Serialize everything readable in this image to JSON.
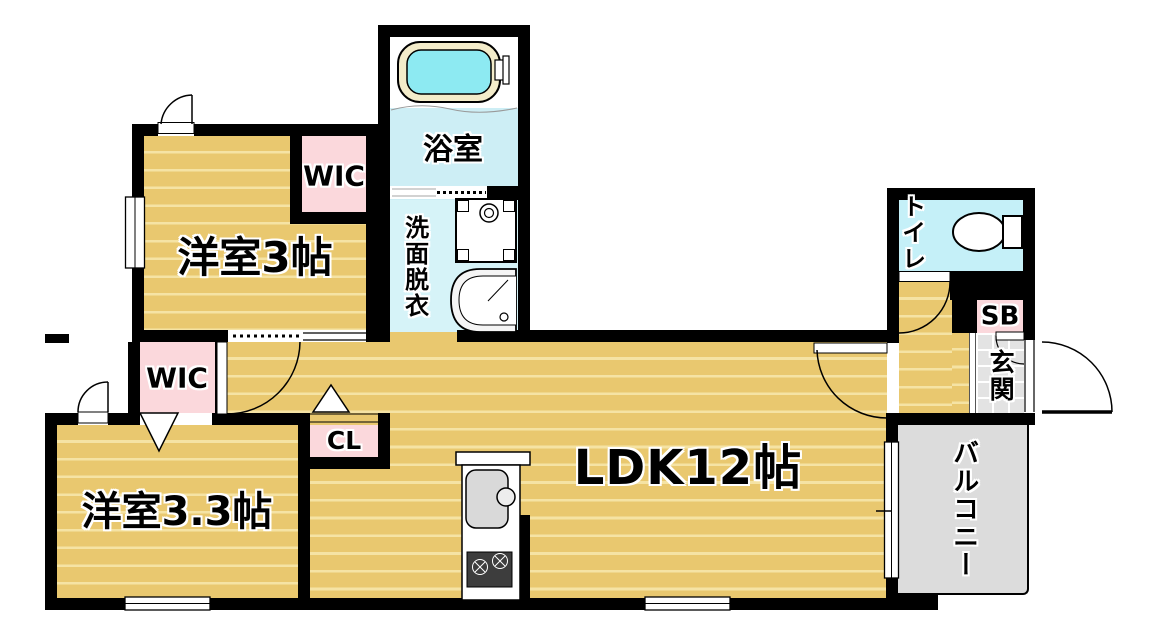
{
  "title": "apartment floor plan",
  "rooms": {
    "bedroom3": {
      "label": "洋室3帖"
    },
    "bedroom33": {
      "label": "洋室3.3帖"
    },
    "ldk": {
      "label": "LDK12帖"
    },
    "bath": {
      "label": "浴室"
    },
    "washroom": {
      "label": "洗面脱衣"
    },
    "toilet": {
      "label": "トイレ"
    },
    "entrance": {
      "label": "玄関"
    },
    "balcony": {
      "label": "バルコニー"
    },
    "wic1": {
      "label": "WIC"
    },
    "wic2": {
      "label": "WIC"
    },
    "closet": {
      "label": "CL"
    },
    "shoebox": {
      "label": "SB"
    }
  },
  "colors": {
    "wood": "#e9c86f",
    "wood_stripe": "#f5e3a4",
    "closet_pink": "#fbd8dc",
    "bath_cyan": "#cdeef5",
    "wash_cyan": "#d6f3f8",
    "toilet_cyan": "#c5f0f8",
    "tub_water": "#8deaf2",
    "tub_rim": "#f3ecca",
    "balcony_gray": "#dcdcdc",
    "tile_gray": "#e3e3e3",
    "wall": "#000000"
  }
}
